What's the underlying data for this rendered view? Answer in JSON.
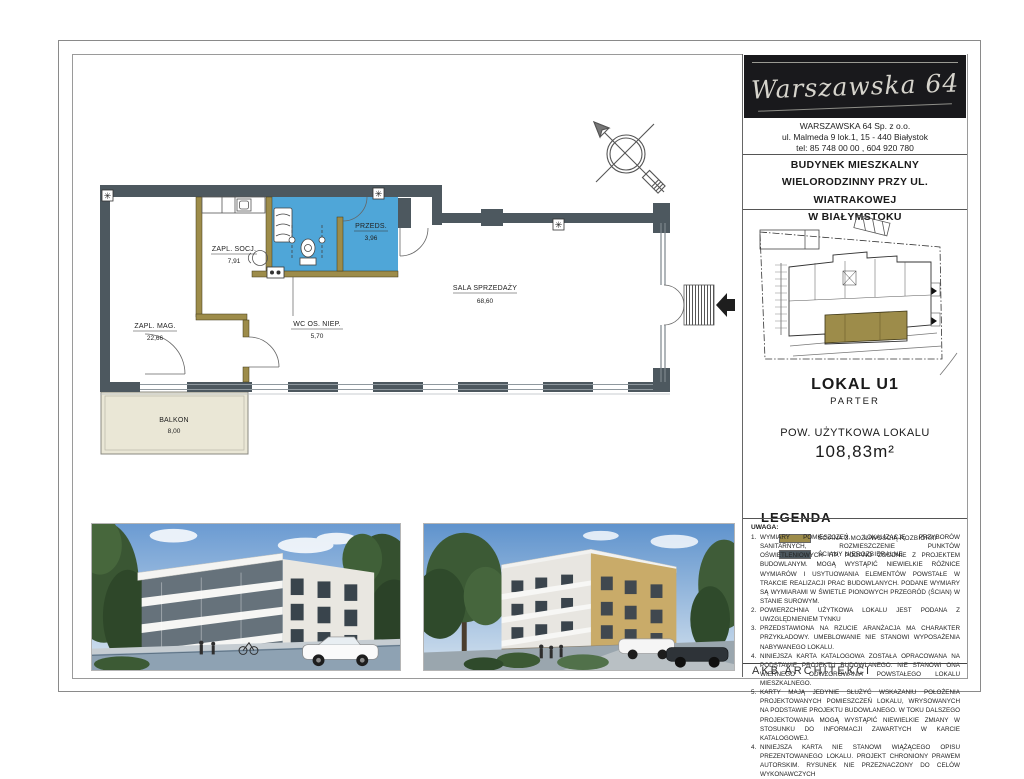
{
  "header": {
    "logo": "Warszawska 64",
    "company": "WARSZAWSKA 64  Sp. z o.o.",
    "address": "ul. Malmeda 9  lok.1,    15 - 440 Białystok",
    "phone": "tel: 85 748 00 00 ,   604 920 780",
    "title_line1": "BUDYNEK  MIESZKALNY",
    "title_line2": "WIELORODZINNY PRZY UL. WIATRAKOWEJ",
    "title_line3": "W  BIAŁYMSTOKU"
  },
  "unit": {
    "name": "LOKAL U1",
    "floor": "PARTER",
    "area_label": "POW. UŻYTKOWA LOKALU",
    "area_value": "108,83m²"
  },
  "legend": {
    "title": "LEGENDA",
    "items": [
      {
        "label": "ŚCIANA Z MOŻLIWOŚCIĄ ROZBIÓRKI",
        "color": "#9d8c4a"
      },
      {
        "label": "ŚCIANY NIEROZBIERALNE",
        "color": "#4d585f"
      }
    ]
  },
  "notes": {
    "title": "UWAGA:",
    "items": [
      {
        "num": "1.",
        "text": "WYMIARY POMIESZCZEŃ, LOKALIZACJĘ PRZYBORÓW SANITARNYCH, ROZMIESZCZENIE PUNKTÓW OŚWIETLENIOWYCH ITP. PODANO ZGODNIE Z PROJEKTEM BUDOWLANYM. MOGĄ WYSTĄPIĆ NIEWIELKIE RÓŻNICE WYMIARÓW I USYTUOWANIA ELEMENTÓW POWSTAŁE W TRAKCIE REALIZACJI PRAC BUDOWLANYCH. PODANE WYMIARY SĄ WYMIARAMI W ŚWIETLE PIONOWYCH PRZEGRÓD (ŚCIAN) W STANIE SUROWYM."
      },
      {
        "num": "2.",
        "text": "POWIERZCHNIA UŻYTKOWA LOKALU JEST PODANA Z UWZGLĘDNIENIEM TYNKU"
      },
      {
        "num": "3.",
        "text": "PRZEDSTAWIONA NA RZUCIE ARANŻACJA MA CHARAKTER PRZYKŁADOWY. UMEBLOWANIE NIE STANOWI WYPOSAŻENIA NABYWANEGO LOKALU."
      },
      {
        "num": "4.",
        "text": "NINIEJSZA KARTA KATALOGOWA ZOSTAŁA OPRACOWANA NA PODSTAWIE PROJEKTU BUDOWLANEGO. NIE STANOWI ONA WIERNEGO ODWZOROWANIA POWSTAŁEGO LOKALU MIESZKALNEGO."
      },
      {
        "num": "5.",
        "text": "KARTY MAJĄ JEDYNIE SŁUŻYĆ WSKAZANIU POŁOŻENIA PROJEKTOWANYCH POMIESZCZEŃ LOKALU, WRYSOWANYCH NA PODSTAWIE PROJEKTU BUDOWLANEGO. W TOKU DALSZEGO PROJEKTOWANIA MOGĄ WYSTĄPIĆ NIEWIELKIE ZMIANY W STOSUNKU DO INFORMACJI ZAWARTYCH W KARCIE KATALOGOWEJ."
      },
      {
        "num": "4.",
        "text": "NINIEJSZA KARTA NIE STANOWI WIĄŻĄCEGO OPISU PREZENTOWANEGO LOKALU. PROJEKT CHRONIONY PRAWEM AUTORSKIM. RYSUNEK NIE PRZEZNACZONY DO CELÓW WYKONAWCZYCH"
      }
    ]
  },
  "footer": {
    "studio": "AKB  ARCHITEKCI"
  },
  "floor_plan": {
    "highlight_color": "#4fa6d8",
    "wall_demolishable_color": "#9d8c4a",
    "wall_fixed_color": "#4d585f",
    "balcony_color": "#eae7d6",
    "rooms": [
      {
        "name": "ZAPL. SOCJ.",
        "area": "7,91"
      },
      {
        "name": "ZAPL. MAG.",
        "area": "22,66"
      },
      {
        "name": "WC OS. NIEP.",
        "area": "5,70"
      },
      {
        "name": "PRZEDS.",
        "area": "3,96"
      },
      {
        "name": "SALA SPRZEDAŻY",
        "area": "68,60"
      },
      {
        "name": "BALKON",
        "area": "8,00"
      }
    ]
  },
  "site_plan": {
    "unit_color": "#9d8c4a"
  }
}
